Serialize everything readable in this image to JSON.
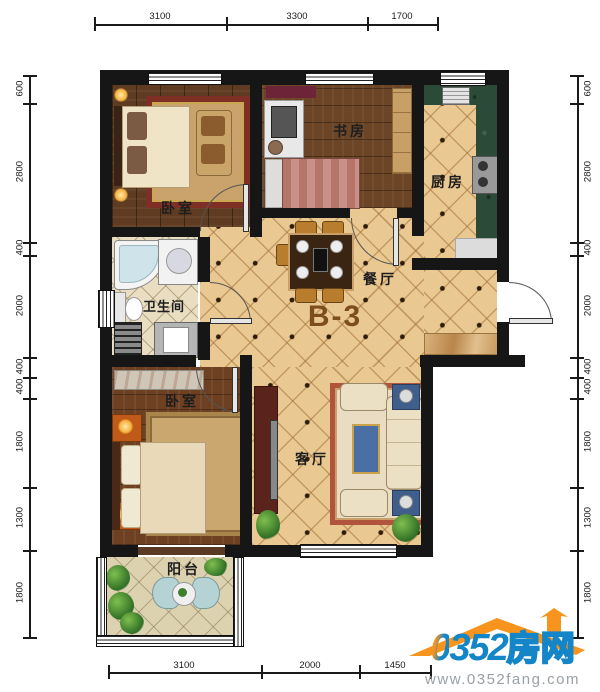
{
  "unit": {
    "label": "B-3"
  },
  "rooms": {
    "bedroom_top": {
      "label": "卧室"
    },
    "study": {
      "label": "书房"
    },
    "kitchen": {
      "label": "厨房"
    },
    "bathroom": {
      "label": "卫生间"
    },
    "dining": {
      "label": "餐厅"
    },
    "bedroom_bottom": {
      "label": "卧室"
    },
    "living": {
      "label": "客厅"
    },
    "balcony": {
      "label": "阳台"
    }
  },
  "dimensions": {
    "top": [
      "3100",
      "3300",
      "1700"
    ],
    "bottom": [
      "3100",
      "2000",
      "1450"
    ],
    "left": [
      "600",
      "2800",
      "400",
      "2000",
      "400",
      "400",
      "1800",
      "1300",
      "1800"
    ],
    "right": [
      "600",
      "2800",
      "400",
      "2000",
      "400",
      "400",
      "1800",
      "1300",
      "1800"
    ]
  },
  "watermark": {
    "brand_zero": "0",
    "brand_digits": "352",
    "brand_cn": "房网",
    "url": "www.0352fang.com"
  },
  "colors": {
    "wall": "#161616",
    "tile": "#eac892",
    "brand_blue": "#1486c8",
    "brand_orange": "#f7941d",
    "unit_label": "#7d4e1d"
  }
}
